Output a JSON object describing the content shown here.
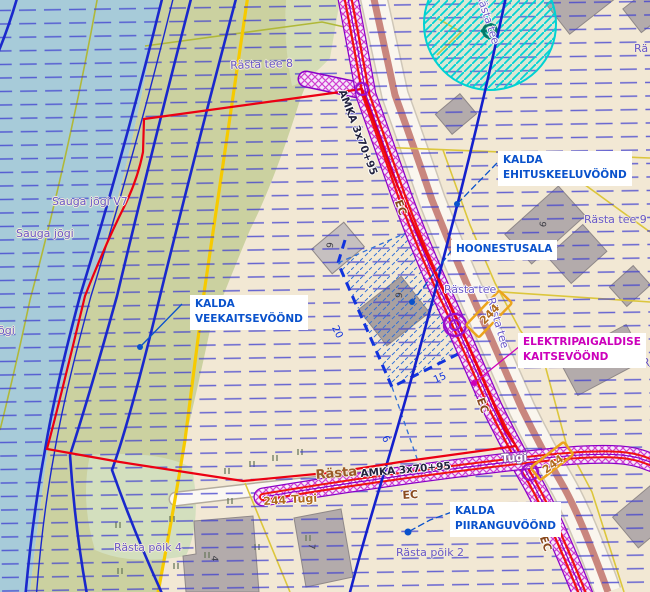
{
  "colors": {
    "water": "#a7cbd9",
    "land_green": "#cbd1a0",
    "background_cream": "#f2e8d4",
    "flood_grid_blue": "#3f3fd0",
    "contour_blue": "#1a28cc",
    "boundary_red": "#ec0012",
    "road_yellow": "#f6ca00",
    "parcel_yellow": "#dcc63c",
    "olive_line": "#b0b838",
    "corridor_magenta": "#d040d0",
    "corridor_purple": "#8a00c8",
    "corridor_red": "#ee1111",
    "cyan_zone": "#00d2d2",
    "annotation_blue": "#0a52cc",
    "annotation_magenta": "#cc00bb",
    "building_gray": "#b3abab"
  },
  "zones": {
    "ehituskeeluvoond": {
      "line1": "KALDA",
      "line2": "EHITUSKEELUVÖÖND"
    },
    "veekaitsevoond": {
      "line1": "KALDA",
      "line2": "VEEKAITSEVÖÖND"
    },
    "piiranguvoond": {
      "line1": "KALDA",
      "line2": "PIIRANGUVÖÖND"
    },
    "hoonestusala": {
      "label": "HOONESTUSALA"
    },
    "elektripaigaldise": {
      "line1": "ELEKTRIPAIGALDISE",
      "line2": "KAITSEVÖÖND"
    }
  },
  "streets": {
    "rasta_tee_8": "Rästa tee 8",
    "rasta_tee_9": "Rästa tee 9",
    "rasta_tee_6": "Rästa tee 6",
    "rasta_tee": "Rästa tee",
    "rasta_poik_4": "Rästa põik 4",
    "rasta_poik_2": "Rästa põik 2",
    "clip_right_top": "Rä",
    "clip_right_mid": "R"
  },
  "water_labels": {
    "sauga_v": "Sauga jõgi V7",
    "sauga": "Sauga jõgi",
    "sauga_clip": "õgi"
  },
  "cable": {
    "name": "AMKA 3x70+95",
    "ec": "EC",
    "tugi": "Tugi",
    "pole": "244",
    "road_name": "Rästa"
  },
  "dimensions": {
    "d20": "20",
    "d15": "15",
    "d6": "6"
  },
  "building_numbers": {
    "n6a": "6",
    "n6b": "6",
    "n9": "9",
    "n1": "1",
    "n4": "4",
    "n7": "7"
  }
}
